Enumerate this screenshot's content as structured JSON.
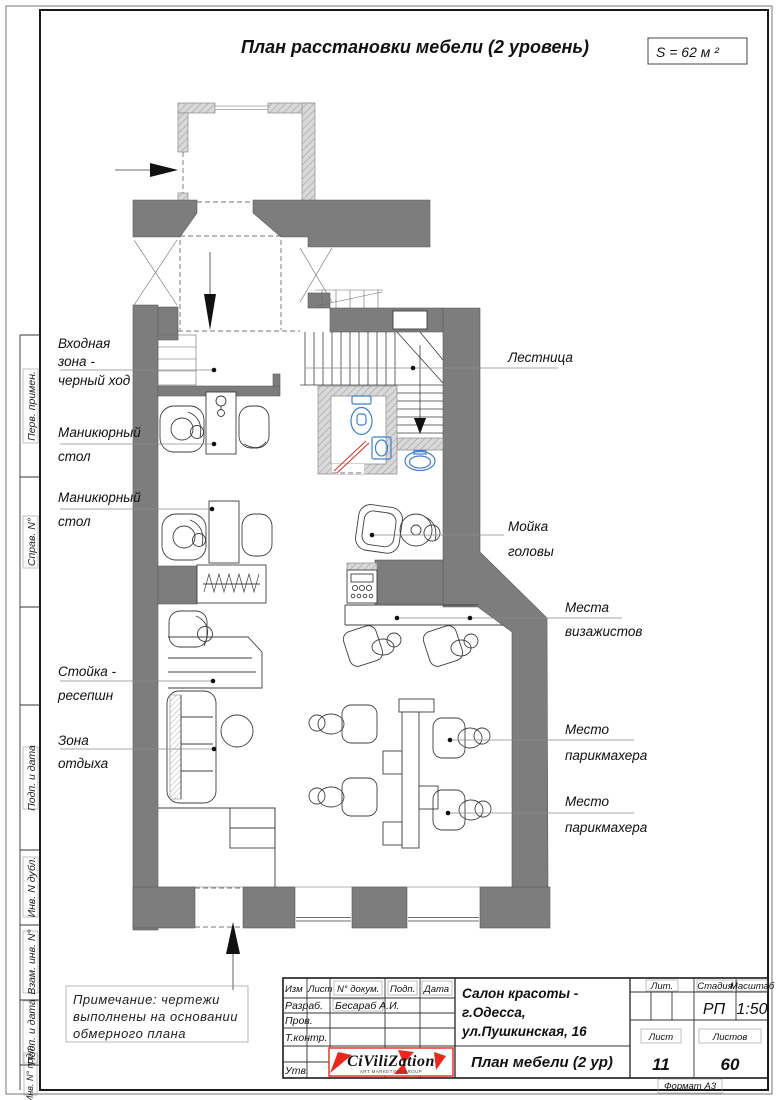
{
  "sheet": {
    "title": "План расстановки мебели (2  уровень)",
    "area": "S = 62 м ²",
    "format": "Формат  А3"
  },
  "margin_cells": {
    "c1": "Перв. примен.",
    "c2": "Справ. N°",
    "c3": "Подп. и дата",
    "c4": "Инв. N дубл.",
    "c5": "Взам. инв. N°",
    "c6": "Подп. и дата",
    "c7": "Инв. N° подл."
  },
  "labels": {
    "entry": [
      "Входная",
      "зона -",
      "черный ход"
    ],
    "manicure": [
      "Маникюрный",
      "стол"
    ],
    "stairs": "Лестница",
    "wash": [
      "Мойка",
      "головы"
    ],
    "makeup": [
      "Места",
      "визажистов"
    ],
    "stylist": [
      "Место",
      "парикмахера"
    ],
    "reception": [
      "Стойка -",
      "ресепшн"
    ],
    "lounge": [
      "Зона",
      "отдыха"
    ]
  },
  "note": [
    "Примечание:  чертежи",
    "выполнены  на  основании",
    "обмерного  плана"
  ],
  "title_block": {
    "cols": [
      "Изм",
      "Лист",
      "N° докум.",
      "Подп.",
      "Дата"
    ],
    "rows": {
      "razrab": "Разраб.",
      "razrab_value": "Бесараб А.И.",
      "prov": "Пров.",
      "tkontr": "Т.контр.",
      "utv": "Утв."
    },
    "project": [
      "Салон красоты -",
      "г.Одесса,",
      "ул.Пушкинская, 16"
    ],
    "doc": "План мебели (2 ур)",
    "lit": "Лит.",
    "stage": "Стадия",
    "stage_value": "РП",
    "scale": "Масштаб",
    "scale_value": "1:50",
    "sheet": "Лист",
    "sheet_value": "11",
    "sheets": "Листов",
    "sheets_value": "60",
    "logo": "CiViliZation",
    "logo_sub": "ART MARKETING GROUP"
  },
  "colors": {
    "wall_dark": "#7d7d7d",
    "wall_hatch": "#d9d9d9",
    "fixture_blue": "#3f7fd0",
    "door_red": "#cf3b30",
    "logo_red": "#e8281c"
  }
}
